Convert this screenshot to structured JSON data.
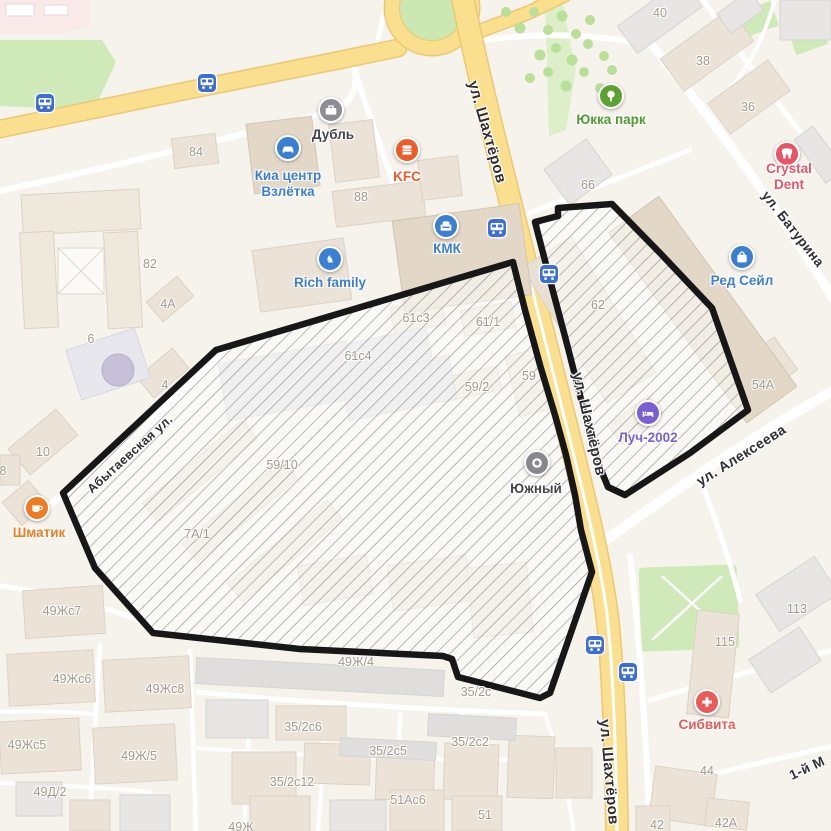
{
  "map": {
    "colors": {
      "land": "#f6f3ed",
      "road_major_fill": "#fadf8e",
      "road_major_casing": "#ecc873",
      "road_minor": "#ffffff",
      "park_green": "#cfe9b8",
      "tree_green": "#b9df98",
      "hospital_pink": "#f9e9e9",
      "building_beige": "#ebe3d7",
      "building_gray": "#e7e6e4",
      "building_dark_beige": "#e3d8c8",
      "transit_blue": "#3c6ed7",
      "selection_stroke": "#171717",
      "hatch_line": "#8b8b8b",
      "building_number_text": "#a39a8d",
      "street_text": "#2f2f33"
    },
    "selection": {
      "stroke_color": "#171717",
      "areas": [
        {
          "id": "west-area",
          "points": "216,350 513,262 525,310 540,365 555,415 566,455 575,495 581,530 592,572 550,693 540,698 497,687 458,677 452,659 443,656 300,649 153,633 95,568 63,493"
        },
        {
          "id": "east-area",
          "points": "535,222 558,216 558,208 612,204 660,253 712,308 748,410 690,453 625,495 608,487 599,465 585,415 568,348 550,280"
        }
      ]
    },
    "pois": [
      {
        "id": "dubl",
        "label": "Дубль",
        "icon": "briefcase-icon",
        "color": "#8c8c92",
        "label_color": "#45454b",
        "ix": 331,
        "iy": 110,
        "lx": 333,
        "ly": 135
      },
      {
        "id": "kia-centr",
        "label": "Киа центр\nВзлётка",
        "icon": "car-icon",
        "color": "#3b7fd2",
        "label_color": "#3b7fd2",
        "ix": 288,
        "iy": 148,
        "lx": 288,
        "ly": 184
      },
      {
        "id": "kfc",
        "label": "KFC",
        "icon": "burger-icon",
        "color": "#ee5b2a",
        "label_color": "#ee5b2a",
        "ix": 407,
        "iy": 150,
        "lx": 407,
        "ly": 177
      },
      {
        "id": "kmk",
        "label": "КМК",
        "icon": "armchair-icon",
        "color": "#3b7fd2",
        "label_color": "#3b7fd2",
        "ix": 446,
        "iy": 226,
        "lx": 447,
        "ly": 249
      },
      {
        "id": "rich-family",
        "label": "Rich family",
        "icon": "rocking-horse-icon",
        "color": "#3b7fd2",
        "label_color": "#3b7fd2",
        "ix": 330,
        "iy": 259,
        "lx": 330,
        "ly": 283
      },
      {
        "id": "yukka-park",
        "label": "Юкка парк",
        "icon": "tree-icon",
        "color": "#5ba32e",
        "label_color": "#4e9a2e",
        "ix": 611,
        "iy": 96,
        "lx": 611,
        "ly": 120
      },
      {
        "id": "crystal-dent",
        "label": "Crystal Dent",
        "icon": "tooth-icon",
        "color": "#e75566",
        "label_color": "#e75566",
        "ix": 787,
        "iy": 154,
        "lx": 789,
        "ly": 177
      },
      {
        "id": "red-sale",
        "label": "Ред Сейл",
        "icon": "shopping-bag-icon",
        "color": "#3b7fd2",
        "label_color": "#3b7fd2",
        "ix": 742,
        "iy": 257,
        "lx": 742,
        "ly": 281
      },
      {
        "id": "luch-2002",
        "label": "Луч-2002",
        "icon": "bed-icon",
        "color": "#7a5fd4",
        "label_color": "#7a5fd4",
        "ix": 648,
        "iy": 413,
        "lx": 648,
        "ly": 438
      },
      {
        "id": "yuzhny",
        "label": "Южный",
        "icon": "ring-icon",
        "color": "#87878d",
        "label_color": "#45454b",
        "ix": 537,
        "iy": 463,
        "lx": 536,
        "ly": 489
      },
      {
        "id": "shmatik",
        "label": "Шматик",
        "icon": "coffee-cup-icon",
        "color": "#ef7b23",
        "label_color": "#ef7b23",
        "ix": 37,
        "iy": 508,
        "lx": 39,
        "ly": 533
      },
      {
        "id": "sibvita",
        "label": "Сибвита",
        "icon": "medical-cross-icon",
        "color": "#ea5a57",
        "label_color": "#ea5a57",
        "ix": 707,
        "iy": 702,
        "lx": 707,
        "ly": 725
      }
    ],
    "street_labels": [
      {
        "text": "ул. Шахтёров",
        "x": 487,
        "y": 132,
        "rot": 74,
        "size": 15
      },
      {
        "text": "ул. Шахтёров",
        "x": 589,
        "y": 424,
        "rot": 77,
        "size": 15
      },
      {
        "text": "ул. Шахтёров",
        "x": 609,
        "y": 772,
        "rot": 85,
        "size": 15
      },
      {
        "text": "ул. Батурина",
        "x": 793,
        "y": 229,
        "rot": 52,
        "size": 13.5
      },
      {
        "text": "ул. Алексеева",
        "x": 741,
        "y": 455,
        "rot": -32,
        "size": 14
      },
      {
        "text": "Абытаевская ул.",
        "x": 130,
        "y": 454,
        "rot": -42,
        "size": 12.5
      },
      {
        "text": "1-й М",
        "x": 807,
        "y": 768,
        "rot": -25,
        "size": 13.5
      }
    ],
    "building_numbers": [
      {
        "text": "84",
        "x": 196,
        "y": 152
      },
      {
        "text": "88",
        "x": 361,
        "y": 197
      },
      {
        "text": "82",
        "x": 150,
        "y": 264
      },
      {
        "text": "4А",
        "x": 168,
        "y": 304
      },
      {
        "text": "6",
        "x": 91,
        "y": 339
      },
      {
        "text": "4",
        "x": 165,
        "y": 385
      },
      {
        "text": "10",
        "x": 43,
        "y": 452
      },
      {
        "text": "8",
        "x": 3,
        "y": 471
      },
      {
        "text": "40",
        "x": 660,
        "y": 13
      },
      {
        "text": "38",
        "x": 703,
        "y": 61
      },
      {
        "text": "36",
        "x": 748,
        "y": 107
      },
      {
        "text": "66",
        "x": 588,
        "y": 185
      },
      {
        "text": "62",
        "x": 598,
        "y": 305
      },
      {
        "text": "54А",
        "x": 763,
        "y": 385
      },
      {
        "text": "61с3",
        "x": 416,
        "y": 318
      },
      {
        "text": "61/1",
        "x": 488,
        "y": 322
      },
      {
        "text": "61с4",
        "x": 358,
        "y": 356
      },
      {
        "text": "59/2",
        "x": 477,
        "y": 387
      },
      {
        "text": "59",
        "x": 529,
        "y": 376
      },
      {
        "text": "59/10",
        "x": 282,
        "y": 465
      },
      {
        "text": "7А/1",
        "x": 197,
        "y": 534
      },
      {
        "text": "49Жс7",
        "x": 62,
        "y": 611
      },
      {
        "text": "49Жс6",
        "x": 72,
        "y": 679
      },
      {
        "text": "49Жс8",
        "x": 165,
        "y": 689
      },
      {
        "text": "49Жс5",
        "x": 27,
        "y": 745
      },
      {
        "text": "49Ж/5",
        "x": 139,
        "y": 756
      },
      {
        "text": "49Д/2",
        "x": 50,
        "y": 792
      },
      {
        "text": "49Ж",
        "x": 241,
        "y": 827
      },
      {
        "text": "49Ж/4",
        "x": 356,
        "y": 662
      },
      {
        "text": "35/2с6",
        "x": 303,
        "y": 727
      },
      {
        "text": "35/2с5",
        "x": 388,
        "y": 751
      },
      {
        "text": "35/2с2",
        "x": 470,
        "y": 742
      },
      {
        "text": "35/2с12",
        "x": 292,
        "y": 782
      },
      {
        "text": "35/2с",
        "x": 476,
        "y": 692
      },
      {
        "text": "51Ас6",
        "x": 408,
        "y": 800
      },
      {
        "text": "51",
        "x": 485,
        "y": 815
      },
      {
        "text": "113",
        "x": 797,
        "y": 609
      },
      {
        "text": "115",
        "x": 725,
        "y": 642
      },
      {
        "text": "44",
        "x": 707,
        "y": 771
      },
      {
        "text": "42",
        "x": 657,
        "y": 825
      },
      {
        "text": "42А",
        "x": 726,
        "y": 823
      }
    ],
    "transit_stops": [
      {
        "x": 45,
        "y": 103
      },
      {
        "x": 207,
        "y": 83
      },
      {
        "x": 497,
        "y": 228
      },
      {
        "x": 549,
        "y": 274
      },
      {
        "x": 595,
        "y": 645
      },
      {
        "x": 628,
        "y": 672
      }
    ]
  }
}
